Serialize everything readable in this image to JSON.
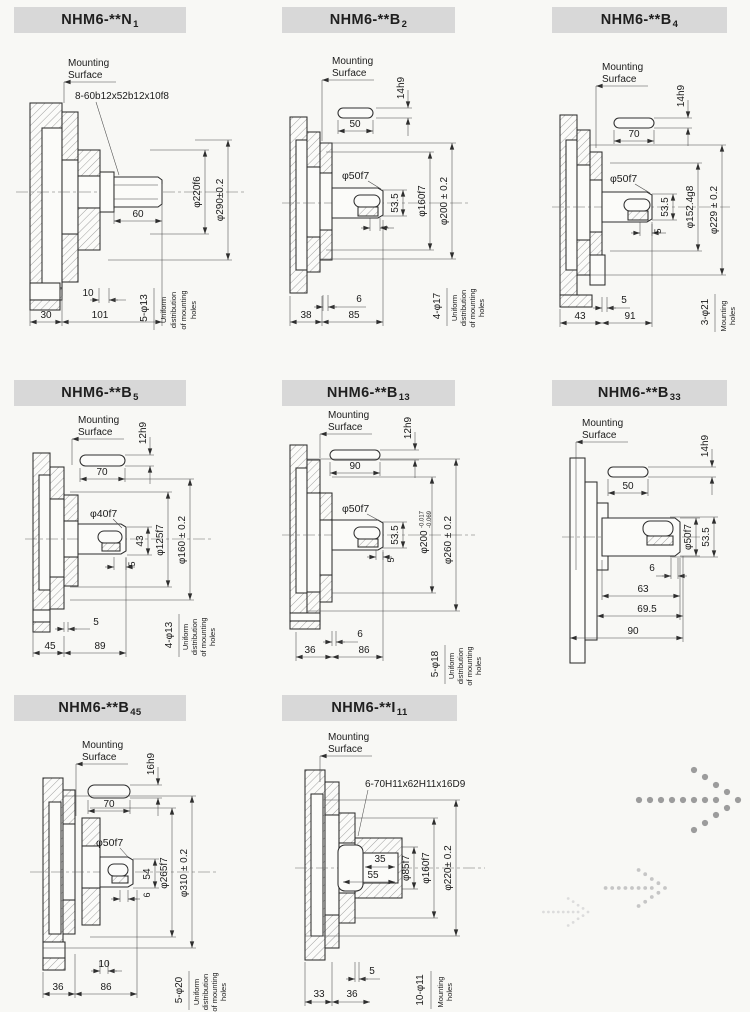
{
  "page": {
    "background": "#f8f8f5",
    "title_bar_color": "#d8d8d8",
    "line_color": "#2e2e2e"
  },
  "panels": [
    {
      "title": {
        "main": "NHM6-**N",
        "sub": "1"
      },
      "labels": {
        "ms1": "Mounting",
        "ms2": "Surface",
        "callout": "8-60b12x52b12x10f8",
        "shaft_len": "60",
        "dia1": "φ220f6",
        "dia2": "φ290±0.2",
        "b1": "10",
        "b2": "30",
        "b3": "101",
        "holes": "5-φ13"
      },
      "note": [
        "Uniform",
        "distribution",
        "of mounting",
        "holes"
      ]
    },
    {
      "title": {
        "main": "NHM6-**B",
        "sub": "2"
      },
      "labels": {
        "ms1": "Mounting",
        "ms2": "Surface",
        "keyh": "14h9",
        "keylen": "50",
        "sdia": "φ50f7",
        "k1": "53.5",
        "k2": "4",
        "dia1": "φ160f7",
        "dia2": "φ200 ± 0.2",
        "b1": "6",
        "b2": "38",
        "b3": "85",
        "holes": "4-φ17"
      },
      "note": [
        "Uniform",
        "distribution",
        "of mounting",
        "holes"
      ]
    },
    {
      "title": {
        "main": "NHM6-**B",
        "sub": "4"
      },
      "labels": {
        "ms1": "Mounting",
        "ms2": "Surface",
        "keyh": "14h9",
        "keylen": "70",
        "sdia": "φ50f7",
        "k1": "53.5",
        "k2": "5",
        "dia1": "φ152.4g8",
        "dia2": "φ229 ± 0.2",
        "b1": "5",
        "b2": "43",
        "b3": "91",
        "holes": "3-φ21"
      },
      "note": [
        "Mounting",
        "holes"
      ]
    },
    {
      "title": {
        "main": "NHM6-**B",
        "sub": "5"
      },
      "labels": {
        "ms1": "Mounting",
        "ms2": "Surface",
        "keyh": "12h9",
        "keylen": "70",
        "sdia": "φ40f7",
        "k1": "43",
        "k2": "5",
        "dia1": "φ125f7",
        "dia2": "φ160 ± 0.2",
        "b1": "5",
        "b2": "45",
        "b3": "89",
        "holes": "4-φ13"
      },
      "note": [
        "Uniform",
        "distribution",
        "of mounting",
        "holes"
      ]
    },
    {
      "title": {
        "main": "NHM6-**B",
        "sub": "13"
      },
      "labels": {
        "ms1": "Mounting",
        "ms2": "Surface",
        "keyh": "12h9",
        "keylen": "90",
        "sdia": "φ50f7",
        "k1": "53.5",
        "k2": "5",
        "dia1": "φ200",
        "dia1_tol_upper": "-0.017",
        "dia1_tol_lower": "-0.069",
        "dia2": "φ260 ± 0.2",
        "b1": "6",
        "b2": "36",
        "b3": "86",
        "holes": "5-φ18"
      },
      "note": [
        "Uniform",
        "distribution",
        "of mounting",
        "holes"
      ]
    },
    {
      "title": {
        "main": "NHM6-**B",
        "sub": "33"
      },
      "labels": {
        "ms1": "Mounting",
        "ms2": "Surface",
        "keyh": "14h9",
        "keylen": "50",
        "sdia": "φ50f7",
        "k1": "53.5",
        "b1": "6",
        "b2": "63",
        "b3": "69.5",
        "b4": "90"
      },
      "note": []
    },
    {
      "title": {
        "main": "NHM6-**B",
        "sub": "45"
      },
      "labels": {
        "ms1": "Mounting",
        "ms2": "Surface",
        "keyh": "16h9",
        "keylen": "70",
        "sdia": "φ50f7",
        "k1": "54",
        "k2": "6",
        "dia1": "φ265f7",
        "dia2": "φ310 ± 0.2",
        "b1": "10",
        "b2": "36",
        "b3": "86",
        "holes": "5-φ20"
      },
      "note": [
        "Uniform",
        "distribution",
        "of mounting",
        "holes"
      ]
    },
    {
      "title": {
        "main": "NHM6-**I",
        "sub": "11"
      },
      "labels": {
        "ms1": "Mounting",
        "ms2": "Surface",
        "callout": "6-70H11x62H11x16D9",
        "i1": "35",
        "i2": "55",
        "dia1": "φ85f7",
        "dia2": "φ160f7",
        "dia3": "φ220± 0.2",
        "b1": "5",
        "b2": "33",
        "b3": "36",
        "holes": "10-φ11"
      },
      "note": [
        "Mounting",
        "holes"
      ]
    }
  ],
  "decor": {
    "arrow_colors": [
      "#9c9c9c",
      "#c6c6c6",
      "#dcdcdc"
    ]
  }
}
